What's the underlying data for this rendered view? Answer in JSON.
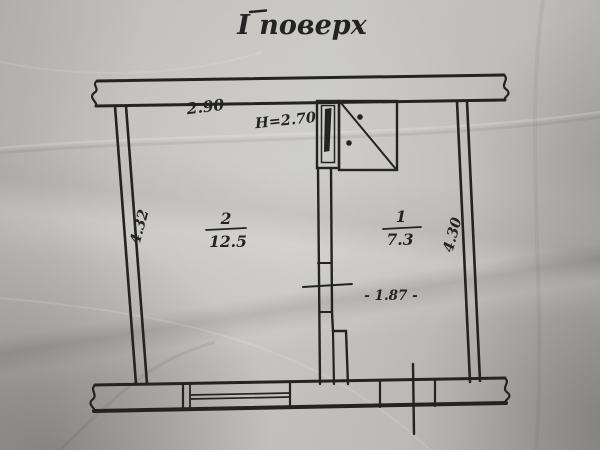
{
  "plan": {
    "title": "І поверх",
    "room_left": {
      "number": "2",
      "area": "12.5"
    },
    "room_right": {
      "number": "1",
      "area": "7.3"
    },
    "dimensions": {
      "top_width": "2.90",
      "ceiling_height": "Н=2.70",
      "left_height": "4.32",
      "right_height": "4.30",
      "right_room_width": "- 1.87 -"
    },
    "colors": {
      "ink": "#1d1d1d",
      "paper": "#b7b6b2"
    }
  }
}
